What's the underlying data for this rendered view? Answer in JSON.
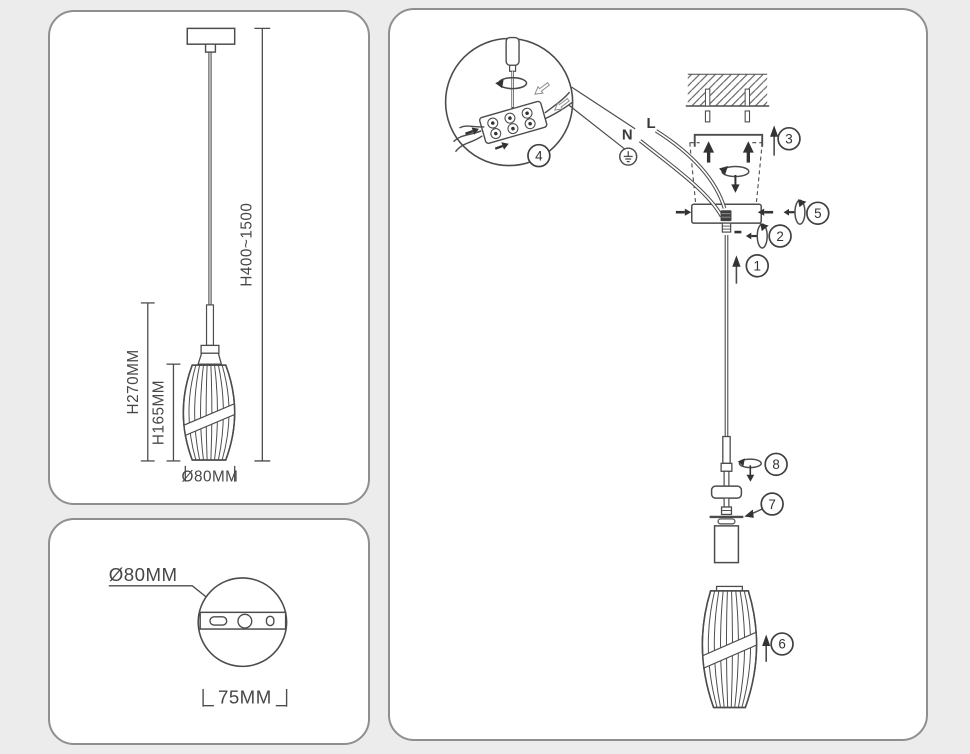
{
  "colors": {
    "background": "#ececec",
    "panel_background": "#ffffff",
    "panel_border": "#8f8f8f",
    "line": "#4c4c4c",
    "text": "#474747"
  },
  "panels": {
    "dimension_view": {
      "overall_height_label": "H400~1500",
      "fixture_height_label": "H270MM",
      "shade_height_label": "H165MM",
      "shade_diameter_label": "Ø80MM"
    },
    "top_view": {
      "canopy_diameter_label": "Ø80MM",
      "mount_spacing_label": "75MM"
    },
    "installation_view": {
      "neutral_label": "N",
      "live_label": "L",
      "steps": [
        "1",
        "2",
        "3",
        "4",
        "5",
        "6",
        "7",
        "8"
      ]
    }
  },
  "components": {
    "inset": [
      "screwdriver-icon",
      "rotation-arrow-icon",
      "terminal-block",
      "wire-arrows"
    ],
    "main": [
      "ceiling-hatch",
      "wall-anchors",
      "mounting-bracket",
      "mounting-screws",
      "canopy",
      "ground-icon",
      "suspension-wire",
      "cord-grip",
      "socket-flange",
      "lamp-holder",
      "glass-shade"
    ]
  }
}
